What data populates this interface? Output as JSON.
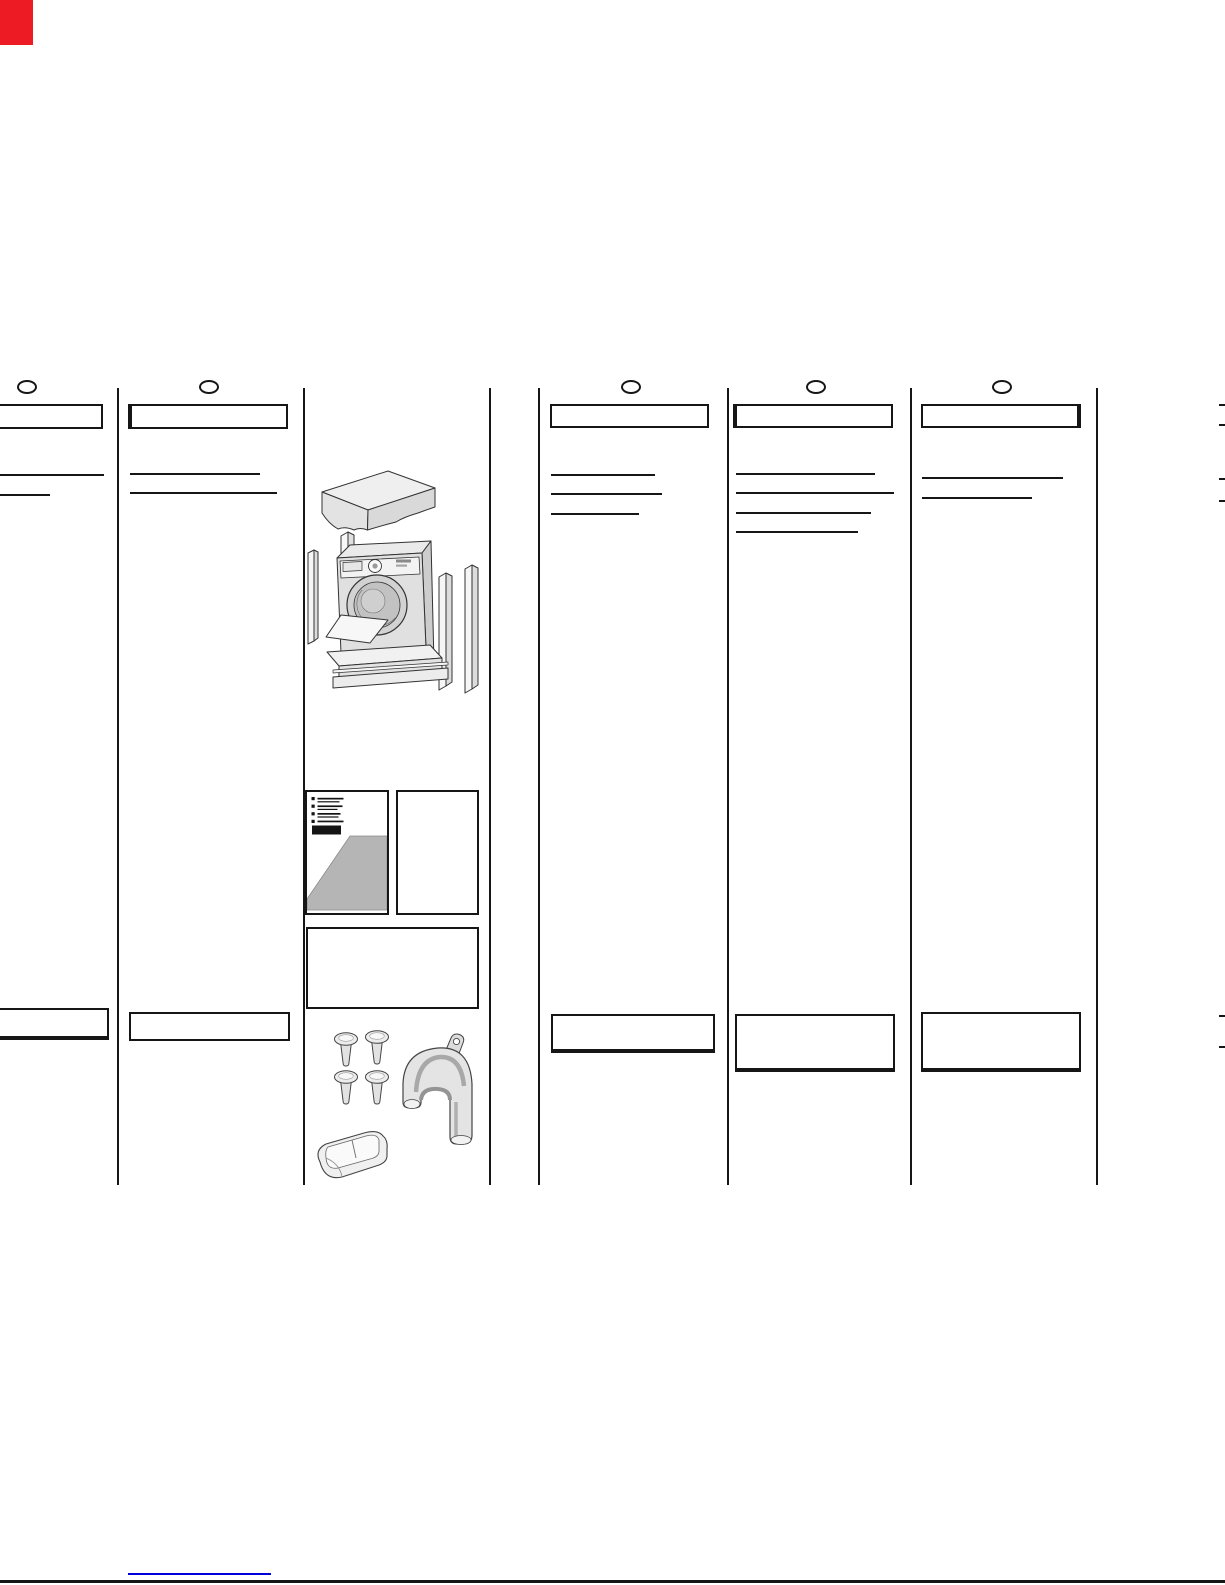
{
  "page": {
    "width": 1225,
    "height": 1585,
    "background": "#ffffff",
    "ink_color": "#161616",
    "corner_tab_color": "#ed1c24",
    "link_line_color": "#0000dd",
    "shade_gray": "#b5b5b5"
  },
  "layout": {
    "divider_top": 388,
    "divider_bottom": 1185,
    "divider_width": 2
  },
  "dividers": [
    {
      "x": 117
    },
    {
      "x": 303
    },
    {
      "x": 489
    },
    {
      "x": 538
    },
    {
      "x": 727
    },
    {
      "x": 910
    },
    {
      "x": 1096
    }
  ],
  "columns": [
    {
      "name": "column-1",
      "ellipse": {
        "cx": 27,
        "cy": 387
      },
      "header_box": {
        "x": -8,
        "y": 404,
        "w": 111,
        "h": 25,
        "thick": null
      },
      "rules": [
        {
          "x": 0,
          "y": 474,
          "w": 104
        },
        {
          "x": 0,
          "y": 494,
          "w": 50
        }
      ],
      "bottom_box": {
        "x": -8,
        "y": 1008,
        "w": 117,
        "h": 32,
        "thick": "bottom"
      }
    },
    {
      "name": "column-2",
      "ellipse": {
        "cx": 209,
        "cy": 387
      },
      "header_box": {
        "x": 128,
        "y": 404,
        "w": 160,
        "h": 25,
        "thick": "left"
      },
      "rules": [
        {
          "x": 130,
          "y": 473,
          "w": 130
        },
        {
          "x": 130,
          "y": 492,
          "w": 147
        }
      ],
      "bottom_box": {
        "x": 129,
        "y": 1012,
        "w": 161,
        "h": 29,
        "thick": null
      }
    },
    {
      "name": "column-3",
      "ellipse": {
        "cx": 631,
        "cy": 387
      },
      "header_box": {
        "x": 550,
        "y": 404,
        "w": 159,
        "h": 24,
        "thick": null
      },
      "rules": [
        {
          "x": 551,
          "y": 474,
          "w": 104
        },
        {
          "x": 551,
          "y": 493,
          "w": 111
        },
        {
          "x": 551,
          "y": 513,
          "w": 88
        }
      ],
      "bottom_box": {
        "x": 551,
        "y": 1014,
        "w": 164,
        "h": 39,
        "thick": "bottom"
      }
    },
    {
      "name": "column-4",
      "ellipse": {
        "cx": 816,
        "cy": 387
      },
      "header_box": {
        "x": 733,
        "y": 404,
        "w": 160,
        "h": 24,
        "thick": "left"
      },
      "rules": [
        {
          "x": 736,
          "y": 473,
          "w": 139
        },
        {
          "x": 736,
          "y": 492,
          "w": 158
        },
        {
          "x": 736,
          "y": 512,
          "w": 135
        },
        {
          "x": 736,
          "y": 531,
          "w": 122
        }
      ],
      "bottom_box": {
        "x": 735,
        "y": 1014,
        "w": 160,
        "h": 58,
        "thick": "bottom"
      }
    },
    {
      "name": "column-5",
      "ellipse": {
        "cx": 1002,
        "cy": 387
      },
      "header_box": {
        "x": 921,
        "y": 404,
        "w": 160,
        "h": 24,
        "thick": "right"
      },
      "rules": [
        {
          "x": 922,
          "y": 477,
          "w": 141
        },
        {
          "x": 922,
          "y": 497,
          "w": 110
        }
      ],
      "bottom_box": {
        "x": 921,
        "y": 1012,
        "w": 160,
        "h": 60,
        "thick": "bottom"
      }
    }
  ],
  "edge_marks": {
    "x": 1219,
    "w": 6,
    "h": 2,
    "ys": [
      404,
      424,
      478,
      500,
      1015,
      1046
    ]
  },
  "corner_tab": {
    "x": 0,
    "y": 0,
    "w": 33,
    "h": 45
  },
  "footer": {
    "link_line": {
      "x": 128,
      "y": 1573,
      "w": 143,
      "h": 2
    },
    "page_edge_line": {
      "x": 0,
      "y": 1580,
      "w": 1225,
      "h": 3
    }
  },
  "illustrations": {
    "region": {
      "x": 300,
      "y": 450,
      "w": 190,
      "h": 735
    },
    "items": [
      "packaging-exploded-view",
      "carton-lid",
      "washing-machine",
      "polystyrene-side-strips",
      "polystyrene-base",
      "instruction-leaflet-box",
      "warranty-card-box",
      "note-box",
      "transit-hole-caps",
      "drain-hose-bracket",
      "detergent-scoop-tray"
    ],
    "leaflet_bullet_rows": 4
  }
}
